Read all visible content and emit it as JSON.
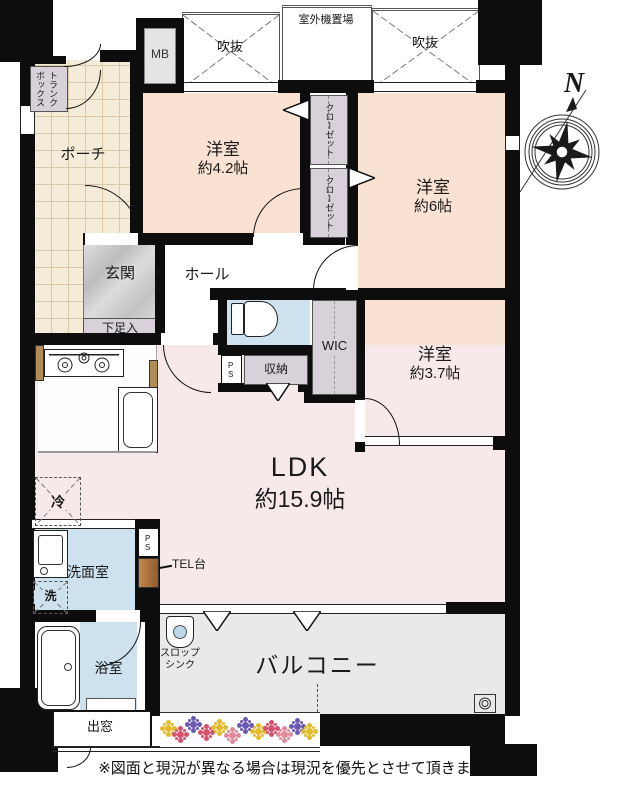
{
  "labels": {
    "outdoor_unit": "室外機置場",
    "mb": "MB",
    "void": "吹抜",
    "trunk_box": "トランクボックス",
    "porch": "ポーチ",
    "closet": "クローゼット",
    "bedroom42_name": "洋室",
    "bedroom42_size": "約4.2帖",
    "bedroom6_name": "洋室",
    "bedroom6_size": "約6帖",
    "bedroom37_name": "洋室",
    "bedroom37_size": "約3.7帖",
    "genkan": "玄関",
    "hall": "ホール",
    "shoe_box": "下足入",
    "wic": "WIC",
    "storage": "収納",
    "ps": "PS",
    "ldk_name": "LDK",
    "ldk_size": "約15.9帖",
    "fridge": "冷",
    "washer": "洗",
    "washroom": "洗面室",
    "tel_stand": "TEL台",
    "bathroom": "浴室",
    "bay_window": "出窓",
    "slop_sink_line1": "スロップ",
    "slop_sink_line2": "シンク",
    "balcony": "バルコニー",
    "compass_north": "N",
    "disclaimer": "※図面と現況が異なる場合は現況を優先とさせて頂きます"
  },
  "colors": {
    "wall": "#0d0d0d",
    "bedroom": "#fae2d2",
    "ldk": "#f7e9e9",
    "porch_tile": "#f4ecd9",
    "water_blue": "#cde2ee",
    "storage_gray": "#d8d1da",
    "balcony_gray": "#e9e9e9",
    "genkan_gray": "#c9c9c9",
    "tel_brown": "#ad743c",
    "flower_palette": [
      "#e3bb2a",
      "#d6516d",
      "#6b58b5",
      "#e08a9b"
    ]
  },
  "balcony": {
    "flowers": [
      {
        "x": 5,
        "y": 12,
        "c": 0
      },
      {
        "x": 17,
        "y": 18,
        "c": 1
      },
      {
        "x": 30,
        "y": 8,
        "c": 2
      },
      {
        "x": 43,
        "y": 16,
        "c": 1
      },
      {
        "x": 56,
        "y": 11,
        "c": 0
      },
      {
        "x": 69,
        "y": 19,
        "c": 3
      },
      {
        "x": 82,
        "y": 9,
        "c": 2
      },
      {
        "x": 95,
        "y": 15,
        "c": 0
      },
      {
        "x": 108,
        "y": 12,
        "c": 1
      },
      {
        "x": 121,
        "y": 18,
        "c": 3
      },
      {
        "x": 134,
        "y": 10,
        "c": 2
      },
      {
        "x": 146,
        "y": 15,
        "c": 0
      }
    ]
  }
}
